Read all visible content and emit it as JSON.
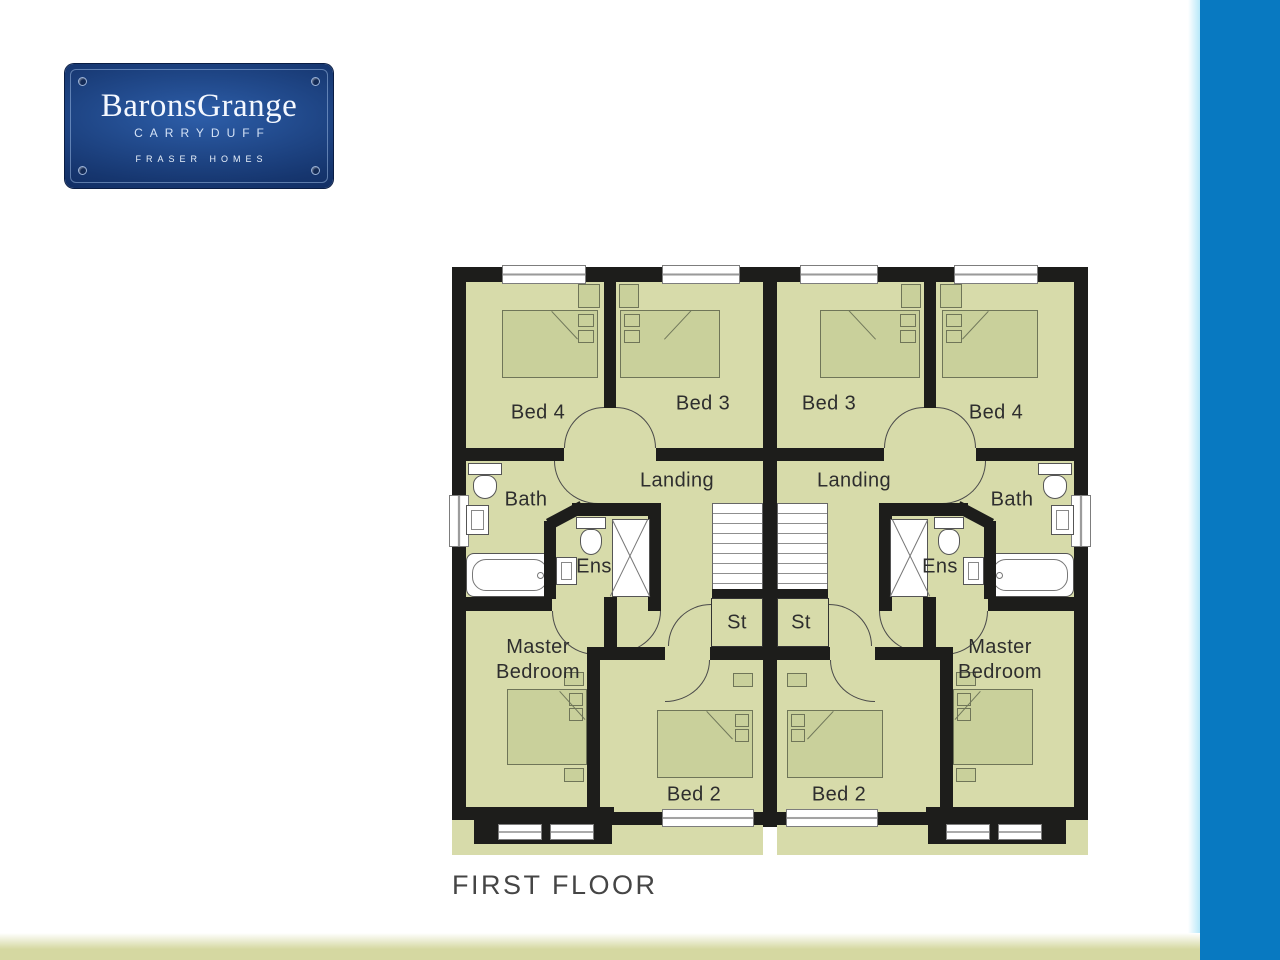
{
  "logo": {
    "title": "BaronsGrange",
    "subtitle": "CARRYDUFF",
    "footer": "FRASER HOMES",
    "bg_dark": "#0a2050",
    "bg_mid": "#16366f",
    "bg_light": "#2d5ea9"
  },
  "floorplan": {
    "caption": "FIRST FLOOR",
    "colors": {
      "wall": "#1d1d1b",
      "floor": "#d7dbaa",
      "furniture": "#c9d09b",
      "furniture_outline": "#6f7558",
      "fixture": "#ffffff",
      "label": "#2e2e2e"
    },
    "labels": {
      "bed4": "Bed 4",
      "bed3": "Bed 3",
      "landing": "Landing",
      "bath": "Bath",
      "ens": "Ens",
      "master_line1": "Master",
      "master_line2": "Bedroom",
      "bed2": "Bed 2",
      "st": "St"
    }
  },
  "accents": {
    "side_bar": "#0879c1",
    "bottom_bar": "#d5d8a1"
  }
}
